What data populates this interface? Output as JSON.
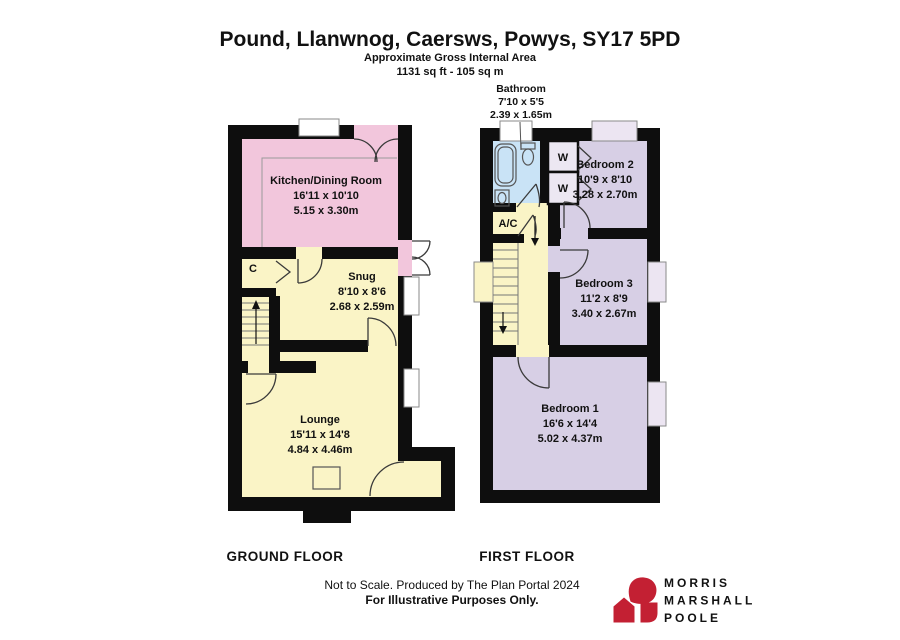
{
  "header": {
    "title": "Pound, Llanwnog, Caersws, Powys, SY17 5PD",
    "subtitle": "Approximate Gross Internal Area",
    "area": "1131 sq ft - 105 sq m"
  },
  "ground_floor": {
    "label": "GROUND FLOOR",
    "rooms": {
      "kitchen": {
        "name": "Kitchen/Dining Room",
        "imperial": "16'11 x 10'10",
        "metric": "5.15 x 3.30m"
      },
      "snug": {
        "name": "Snug",
        "imperial": "8'10 x 8'6",
        "metric": "2.68 x 2.59m"
      },
      "lounge": {
        "name": "Lounge",
        "imperial": "15'11 x 14'8",
        "metric": "4.84 x 4.46m"
      },
      "cupboard": {
        "abbr": "C"
      }
    }
  },
  "first_floor": {
    "label": "FIRST FLOOR",
    "rooms": {
      "bathroom": {
        "name": "Bathroom",
        "imperial": "7'10 x 5'5",
        "metric": "2.39 x 1.65m"
      },
      "bedroom1": {
        "name": "Bedroom 1",
        "imperial": "16'6 x 14'4",
        "metric": "5.02 x 4.37m"
      },
      "bedroom2": {
        "name": "Bedroom 2",
        "imperial": "10'9 x 8'10",
        "metric": "3.28 x 2.70m"
      },
      "bedroom3": {
        "name": "Bedroom 3",
        "imperial": "11'2 x 8'9",
        "metric": "3.40 x 2.67m"
      },
      "airing_cupboard": {
        "abbr": "A/C"
      },
      "wardrobe1": {
        "abbr": "W"
      },
      "wardrobe2": {
        "abbr": "W"
      }
    }
  },
  "footer": {
    "line1": "Not to Scale. Produced by The Plan Portal 2024",
    "line2": "For Illustrative Purposes Only."
  },
  "logo": {
    "line1": "MORRIS",
    "line2": "MARSHALL",
    "line3": "POOLE",
    "color": "#c32033"
  },
  "colors": {
    "kitchen_pink": "#f2c6dc",
    "living_yellow": "#faf4c6",
    "bathroom_blue": "#c9e3f6",
    "bedroom_purple": "#d7cfe5",
    "wardrobe_fill": "#ece7f2",
    "window_white": "#ffffff",
    "window_lavender": "#ece5f2",
    "logo_red": "#c32033"
  }
}
